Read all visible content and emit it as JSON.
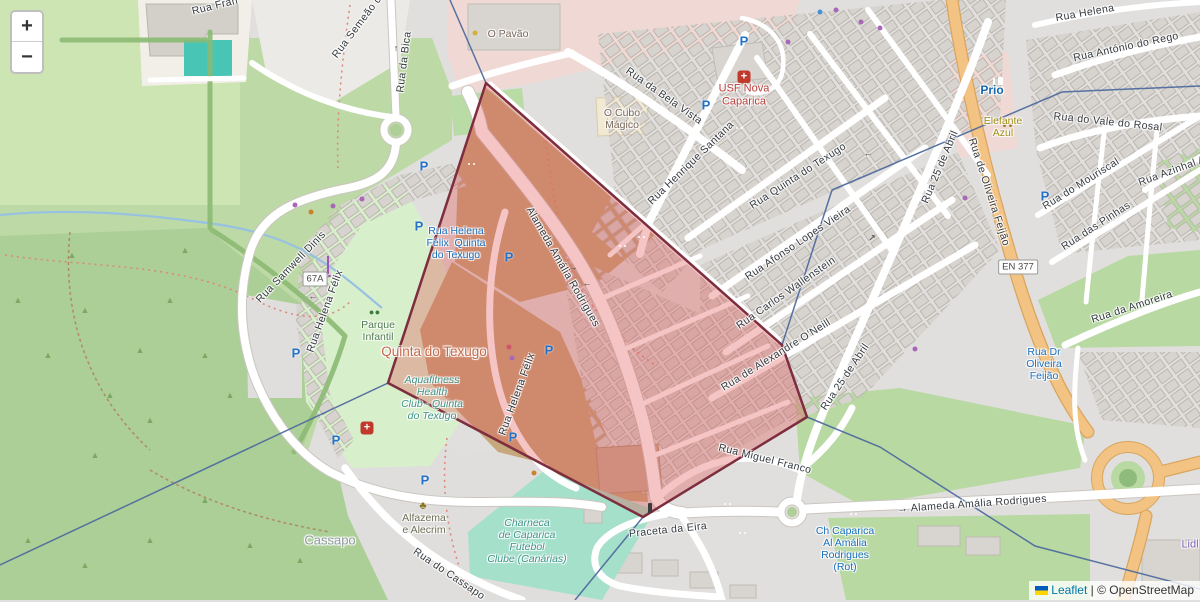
{
  "controls": {
    "zoom_in": "+",
    "zoom_out": "−"
  },
  "attribution": {
    "flag": "ukraine-flag",
    "leaflet": "Leaflet",
    "separator": " | ",
    "copyright": "© OpenStreetMap"
  },
  "highlight": {
    "points": "486,83 782,345 807,417 643,517 388,383",
    "fill": "rgba(224,76,76,0.33)",
    "stroke": "#7c2d3e"
  },
  "colors": {
    "residential": "#e0dfdd",
    "grass": "#cde4b3",
    "forest": "#abcf96",
    "pitch": "#a5e0cb",
    "commercial": "#f0d9d4",
    "scrub_brown": "#c6a87c",
    "road_orange": "#f2c383",
    "boundary_blue": "#4f6b9e",
    "water": "#96c1e3",
    "transit_blue": "#1a6fbe"
  },
  "labels": [
    {
      "t": "Rua Fran",
      "x": 215,
      "y": 6,
      "r": -14,
      "c": "st"
    },
    {
      "t": "Rua Semeão d",
      "x": 357,
      "y": 27,
      "r": -53,
      "c": "st"
    },
    {
      "t": "Rua da Bica",
      "x": 404,
      "y": 62,
      "r": -83,
      "c": "st"
    },
    {
      "t": "Rua Helena Félix",
      "x": 325,
      "y": 311,
      "r": -70,
      "c": "st"
    },
    {
      "t": "Rua Samwell Dinis",
      "x": 291,
      "y": 267,
      "r": -46,
      "c": "st"
    },
    {
      "t": "Rua da Bela Vista",
      "x": 664,
      "y": 96,
      "r": 35,
      "c": "st"
    },
    {
      "t": "Rua Henrique Santana",
      "x": 691,
      "y": 163,
      "r": -44,
      "c": "st"
    },
    {
      "t": "Rua Quinta do Texugo",
      "x": 798,
      "y": 176,
      "r": -33,
      "c": "st"
    },
    {
      "t": "Rua Afonso Lopes Vieira",
      "x": 798,
      "y": 243,
      "r": -34,
      "c": "st"
    },
    {
      "t": "Rua Carlos Wallenstein",
      "x": 786,
      "y": 293,
      "r": -35,
      "c": "st"
    },
    {
      "t": "Rua de Alexandre O'Neill",
      "x": 776,
      "y": 355,
      "r": -32,
      "c": "st"
    },
    {
      "t": "Rua Miguel Franco",
      "x": 765,
      "y": 459,
      "r": 14,
      "c": "st"
    },
    {
      "t": "Praceta da Eira",
      "x": 668,
      "y": 530,
      "r": -6,
      "c": "st"
    },
    {
      "t": "→ Alameda Amália Rodrigues",
      "x": 972,
      "y": 504,
      "r": -4,
      "c": "st"
    },
    {
      "t": "Alameda Amália Rodrigues",
      "x": 563,
      "y": 267,
      "r": 60,
      "c": "st"
    },
    {
      "t": "Rua Helena Félix",
      "x": 517,
      "y": 394,
      "r": -70,
      "c": "st"
    },
    {
      "t": "Rua do Cassapo",
      "x": 449,
      "y": 574,
      "r": 34,
      "c": "st"
    },
    {
      "t": "Rua 25 de Abril",
      "x": 940,
      "y": 167,
      "r": -67,
      "c": "st"
    },
    {
      "t": "Rua 25 de Abril",
      "x": 845,
      "y": 377,
      "r": -56,
      "c": "st"
    },
    {
      "t": "Rua de Oliveira Feijão",
      "x": 989,
      "y": 192,
      "r": 72,
      "c": "st"
    },
    {
      "t": "Rua do Mouriscal",
      "x": 1081,
      "y": 184,
      "r": -32,
      "c": "st"
    },
    {
      "t": "Rua das Pinhas",
      "x": 1096,
      "y": 226,
      "r": -33,
      "c": "st"
    },
    {
      "t": "Rua da Amoreira",
      "x": 1132,
      "y": 307,
      "r": -18,
      "c": "st"
    },
    {
      "t": "Rua do Vale do Rosal",
      "x": 1108,
      "y": 122,
      "r": 6,
      "c": "st"
    },
    {
      "t": "Rua António do Rego",
      "x": 1126,
      "y": 47,
      "r": -12,
      "c": "st"
    },
    {
      "t": "Rua Helena",
      "x": 1085,
      "y": 13,
      "r": -10,
      "c": "st"
    },
    {
      "t": "Rua Azinhal A",
      "x": 1172,
      "y": 171,
      "r": -20,
      "c": "st"
    },
    {
      "t": "O Pavão",
      "x": 508,
      "y": 34,
      "r": 0,
      "c": "poi"
    },
    {
      "t": "O Cubo\nMágico",
      "x": 622,
      "y": 119,
      "r": 0,
      "c": "poi"
    },
    {
      "t": "Cassapo",
      "x": 330,
      "y": 541,
      "r": 0,
      "c": "place"
    },
    {
      "t": "Quinta do Texugo",
      "x": 434,
      "y": 352,
      "r": 0,
      "c": "hamlet"
    },
    {
      "t": "Parque\nInfantil",
      "x": 378,
      "y": 331,
      "r": 0,
      "c": "lgreen"
    },
    {
      "t": "Aquafitness\nHealth\nClub - Quinta\ndo Texugo",
      "x": 432,
      "y": 398,
      "r": 0,
      "c": "leisure"
    },
    {
      "t": "Alfazema\ne Alecrim",
      "x": 424,
      "y": 524,
      "r": 0,
      "c": "olive"
    },
    {
      "t": "Charneca\nde Caparica\nFutebol\nClube (Canárias)",
      "x": 527,
      "y": 541,
      "r": 0,
      "c": "leisure"
    },
    {
      "t": "USF Nova\nCaparica",
      "x": 744,
      "y": 95,
      "r": 0,
      "c": "med"
    },
    {
      "t": "Prio",
      "x": 992,
      "y": 91,
      "r": 0,
      "c": "bblue"
    },
    {
      "t": "Elefante\nAzul",
      "x": 1003,
      "y": 127,
      "r": 0,
      "c": "bolive"
    },
    {
      "t": "Lidl",
      "x": 1190,
      "y": 545,
      "r": 0,
      "c": "bpurple"
    },
    {
      "t": "Rua Helena\nFélix  Quinta\ndo Texugo",
      "x": 456,
      "y": 243,
      "r": 0,
      "c": "tblue"
    },
    {
      "t": "Ch Caparica\nAl Amália\nRodrigues\n(Rot)",
      "x": 845,
      "y": 549,
      "r": 0,
      "c": "tblue"
    },
    {
      "t": "Rua Dr\nOliveira\nFeijão",
      "x": 1044,
      "y": 364,
      "r": 0,
      "c": "tblue"
    }
  ],
  "badges": [
    {
      "t": "EN 377",
      "x": 1018,
      "y": 267
    },
    {
      "t": "67A",
      "x": 315,
      "y": 279
    }
  ],
  "icons": [
    {
      "type": "parking",
      "x": 424,
      "y": 166
    },
    {
      "type": "parking",
      "x": 419,
      "y": 226
    },
    {
      "type": "parking",
      "x": 509,
      "y": 257
    },
    {
      "type": "parking",
      "x": 549,
      "y": 350
    },
    {
      "type": "parking",
      "x": 296,
      "y": 353
    },
    {
      "type": "parking",
      "x": 336,
      "y": 440
    },
    {
      "type": "parking",
      "x": 425,
      "y": 480
    },
    {
      "type": "parking",
      "x": 513,
      "y": 437
    },
    {
      "type": "parking",
      "x": 744,
      "y": 41
    },
    {
      "type": "parking",
      "x": 706,
      "y": 105
    },
    {
      "type": "parking",
      "x": 1045,
      "y": 196
    },
    {
      "type": "bus",
      "x": 466,
      "y": 149
    },
    {
      "type": "bus",
      "x": 457,
      "y": 217
    },
    {
      "type": "bus",
      "x": 617,
      "y": 231
    },
    {
      "type": "bus",
      "x": 636,
      "y": 222
    },
    {
      "type": "bus",
      "x": 734,
      "y": 113
    },
    {
      "type": "bus",
      "x": 722,
      "y": 489
    },
    {
      "type": "bus",
      "x": 848,
      "y": 499
    },
    {
      "type": "bus",
      "x": 843,
      "y": 518
    },
    {
      "type": "bus",
      "x": 737,
      "y": 518
    },
    {
      "type": "bus",
      "x": 827,
      "y": 423
    },
    {
      "type": "hospital",
      "x": 744,
      "y": 77
    },
    {
      "type": "hospital",
      "x": 367,
      "y": 428
    },
    {
      "type": "fuel",
      "x": 996,
      "y": 75
    },
    {
      "type": "carwash",
      "x": 1002,
      "y": 108
    },
    {
      "type": "florist",
      "x": 423,
      "y": 506
    },
    {
      "type": "playground",
      "x": 374,
      "y": 312
    },
    {
      "type": "cart",
      "x": 327,
      "y": 256
    },
    {
      "type": "traffic",
      "x": 650,
      "y": 508
    },
    {
      "type": "dot",
      "x": 295,
      "y": 205,
      "color": "#a868b8"
    },
    {
      "type": "dot",
      "x": 311,
      "y": 212,
      "color": "#c9822e"
    },
    {
      "type": "dot",
      "x": 333,
      "y": 206,
      "color": "#a868b8"
    },
    {
      "type": "dot",
      "x": 362,
      "y": 199,
      "color": "#a868b8"
    },
    {
      "type": "dot",
      "x": 836,
      "y": 10,
      "color": "#a868b8"
    },
    {
      "type": "dot",
      "x": 861,
      "y": 22,
      "color": "#a868b8"
    },
    {
      "type": "dot",
      "x": 788,
      "y": 42,
      "color": "#a868b8"
    },
    {
      "type": "dot",
      "x": 820,
      "y": 12,
      "color": "#4a90d9"
    },
    {
      "type": "dot",
      "x": 965,
      "y": 198,
      "color": "#a868b8"
    },
    {
      "type": "dot",
      "x": 915,
      "y": 349,
      "color": "#a868b8"
    },
    {
      "type": "dot",
      "x": 509,
      "y": 347,
      "color": "#d05570"
    },
    {
      "type": "dot",
      "x": 512,
      "y": 358,
      "color": "#a868b8"
    },
    {
      "type": "dot",
      "x": 534,
      "y": 473,
      "color": "#c9822e"
    },
    {
      "type": "dot",
      "x": 475,
      "y": 33,
      "color": "#d4b03c"
    },
    {
      "type": "dot",
      "x": 880,
      "y": 28,
      "color": "#a868b8"
    },
    {
      "type": "arrow",
      "x": 313,
      "y": 296,
      "char": "←"
    },
    {
      "type": "arrow",
      "x": 573,
      "y": 267,
      "char": "→"
    },
    {
      "type": "arrow",
      "x": 587,
      "y": 283,
      "char": "←"
    },
    {
      "type": "arrow",
      "x": 868,
      "y": 153,
      "char": "←"
    },
    {
      "type": "arrow",
      "x": 396,
      "y": 48,
      "char": "↑"
    },
    {
      "type": "arrow",
      "x": 872,
      "y": 238,
      "char": "↗"
    },
    {
      "type": "tree",
      "x": 18,
      "y": 300
    },
    {
      "type": "tree",
      "x": 48,
      "y": 355
    },
    {
      "type": "tree",
      "x": 85,
      "y": 310
    },
    {
      "type": "tree",
      "x": 72,
      "y": 255
    },
    {
      "type": "tree",
      "x": 110,
      "y": 395
    },
    {
      "type": "tree",
      "x": 140,
      "y": 350
    },
    {
      "type": "tree",
      "x": 95,
      "y": 455
    },
    {
      "type": "tree",
      "x": 170,
      "y": 300
    },
    {
      "type": "tree",
      "x": 185,
      "y": 250
    },
    {
      "type": "tree",
      "x": 205,
      "y": 355
    },
    {
      "type": "tree",
      "x": 150,
      "y": 420
    },
    {
      "type": "tree",
      "x": 230,
      "y": 395
    },
    {
      "type": "tree",
      "x": 28,
      "y": 540
    },
    {
      "type": "tree",
      "x": 85,
      "y": 565
    },
    {
      "type": "tree",
      "x": 150,
      "y": 540
    },
    {
      "type": "tree",
      "x": 250,
      "y": 545
    },
    {
      "type": "tree",
      "x": 205,
      "y": 500
    },
    {
      "type": "tree",
      "x": 300,
      "y": 560
    }
  ]
}
